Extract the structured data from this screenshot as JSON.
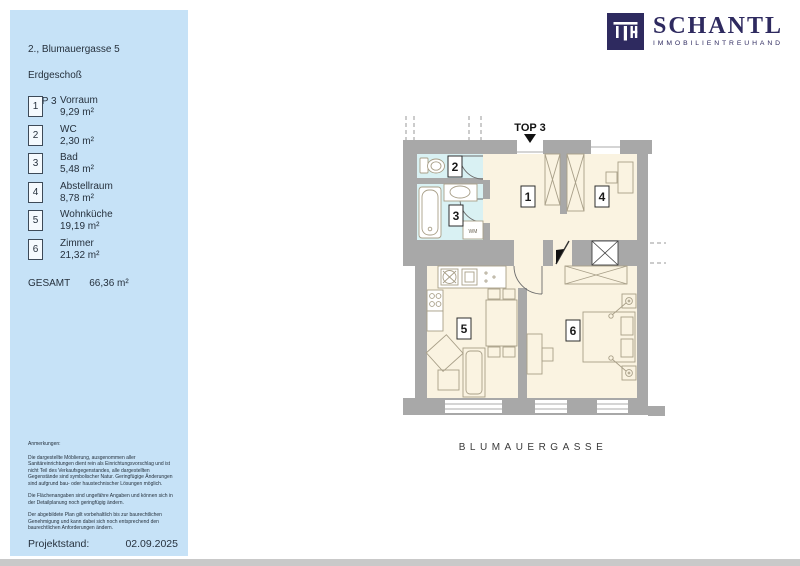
{
  "sidebar": {
    "address_line1": "2., Blumauergasse 5",
    "address_line2": "Erdgeschoß",
    "address_line3": "TOP  3",
    "rooms": [
      {
        "no": "1",
        "name": "Vorraum",
        "area": "9,29 m²"
      },
      {
        "no": "2",
        "name": "WC",
        "area": "2,30 m²"
      },
      {
        "no": "3",
        "name": "Bad",
        "area": "5,48 m²"
      },
      {
        "no": "4",
        "name": "Abstellraum",
        "area": "8,78 m²"
      },
      {
        "no": "5",
        "name": "Wohnküche",
        "area": "19,19 m²"
      },
      {
        "no": "6",
        "name": "Zimmer",
        "area": "21,32 m²"
      }
    ],
    "total_label": "GESAMT",
    "total_area": "66,36 m²",
    "notes_title": "Anmerkungen:",
    "notes": [
      "Die dargestellte Möblierung, ausgenommen aller Sanitäreinrichtungen dient rein als Einrichtungsvorschlag und ist nicht Teil des Verkaufsgegenstandes, alle dargestellten Gegenstände sind symbolischer Natur. Geringfügige Änderungen sind aufgrund bau- oder haustechnischer Lösungen möglich.",
      "Die Flächenangaben sind ungefähre Angaben und können sich in der Detailplanung noch geringfügig ändern.",
      "Der abgebildete Plan gilt vorbehaltlich bis zur baurechtlichen Genehmigung und kann dabei sich noch entsprechend den baurechtlichen Anforderungen ändern."
    ],
    "project_label": "Projektstand:",
    "project_date": "02.09.2025"
  },
  "logo": {
    "monogram": "ITH",
    "name": "SCHANTL",
    "subtitle": "IMMOBILIENTREUHAND"
  },
  "plan": {
    "unit_label": "TOP 3",
    "street_label": "BLUMAUERGASSE",
    "washer_label": "WM",
    "room_numbers": [
      "1",
      "2",
      "3",
      "4",
      "5",
      "6"
    ]
  },
  "colors": {
    "panel_blue": "#c6e2f7",
    "brand_navy": "#2e2a5f",
    "wall_gray": "#a8a8a8",
    "room_cream": "#faf3e1",
    "bath_cyan": "#d9f1f3"
  }
}
